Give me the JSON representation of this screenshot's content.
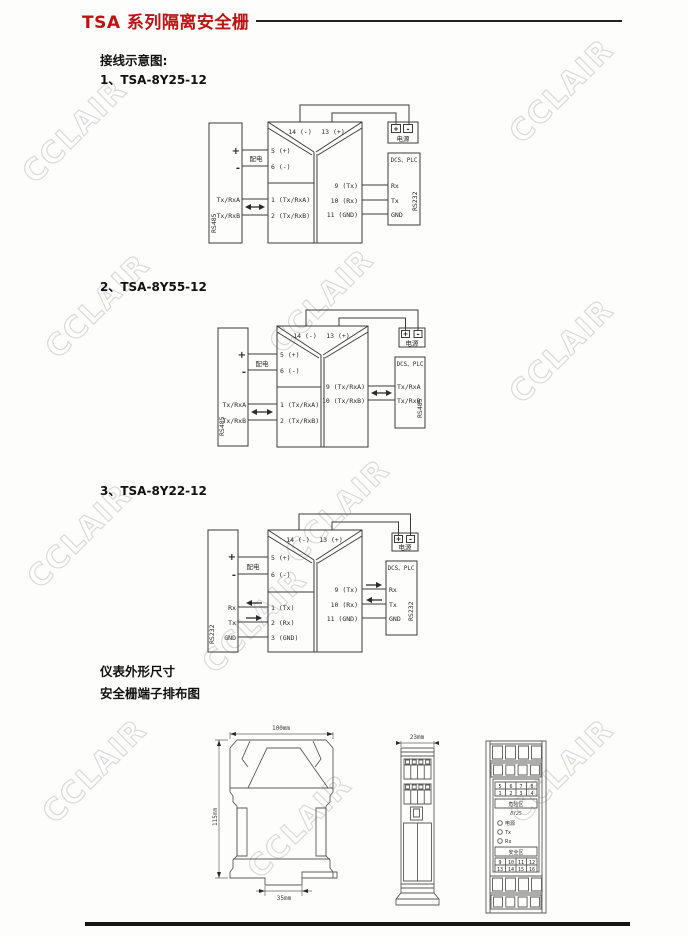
{
  "header": {
    "title": "TSA 系列隔离安全栅"
  },
  "headings": {
    "wiring": "接线示意图:",
    "item1": "1、TSA-8Y25-12",
    "item2": "2、TSA-8Y55-12",
    "item3": "3、TSA-8Y22-12",
    "dims": "仪表外形尺寸",
    "terminals": "安全栅端子排布图"
  },
  "watermark": {
    "text": "CCLAIR"
  },
  "colors": {
    "title_red": "#c01212",
    "line_black": "#1a1a1a",
    "stroke_gray": "#3c3c3c"
  },
  "diagram1": {
    "left_device": {
      "bus": "RS485",
      "plus": "+",
      "minus": "-",
      "power": "配电",
      "rows": [
        "Tx/RxA",
        "Tx/RxB"
      ]
    },
    "barrier": {
      "top": [
        "14 (-)",
        "13 (+)"
      ],
      "left_upper": [
        "5 (+)",
        "6 (-)"
      ],
      "left_lower": [
        "1 (Tx/RxA)",
        "2 (Tx/RxB)"
      ],
      "right": [
        "9 (Tx)",
        "10 (Rx)",
        "11 (GND)"
      ]
    },
    "power_box": {
      "plus": "+",
      "minus": "-",
      "label": "电源"
    },
    "right_device": {
      "title": "DCS、PLC",
      "rows": [
        "Rx",
        "Tx",
        "GND"
      ],
      "bus": "RS232"
    }
  },
  "diagram2": {
    "left_device": {
      "bus": "RS485",
      "plus": "+",
      "minus": "-",
      "power": "配电",
      "rows": [
        "Tx/RxA",
        "Tx/RxB"
      ]
    },
    "barrier": {
      "top": [
        "14 (-)",
        "13 (+)"
      ],
      "left_upper": [
        "5 (+)",
        "6 (-)"
      ],
      "left_lower": [
        "1 (Tx/RxA)",
        "2 (Tx/RxB)"
      ],
      "right": [
        "9 (Tx/RxA)",
        "10 (Tx/RxB)"
      ]
    },
    "power_box": {
      "plus": "+",
      "minus": "-",
      "label": "电源"
    },
    "right_device": {
      "title": "DCS、PLC",
      "rows": [
        "Tx/RxA",
        "Tx/RxB"
      ],
      "bus": "RS485"
    }
  },
  "diagram3": {
    "left_device": {
      "bus": "RS232",
      "plus": "+",
      "minus": "-",
      "power": "配电",
      "rows": [
        "Rx",
        "Tx",
        "GND"
      ]
    },
    "barrier": {
      "top": [
        "14 (-)",
        "13 (+)"
      ],
      "left_upper": [
        "5 (+)",
        "6 (-)"
      ],
      "left_lower": [
        "1 (Tx)",
        "2 (Rx)",
        "3 (GND)"
      ],
      "right": [
        "9 (Tx)",
        "10 (Rx)",
        "11 (GND)"
      ]
    },
    "power_box": {
      "plus": "+",
      "minus": "-",
      "label": "电源"
    },
    "right_device": {
      "title": "DCS、PLC",
      "rows": [
        "Rx",
        "Tx",
        "GND"
      ],
      "bus": "RS232"
    }
  },
  "outline_drawing": {
    "width": "100mm",
    "height": "115mm",
    "rail": "35mm"
  },
  "front_drawing": {
    "width": "23mm"
  },
  "terminal_card": {
    "top_row1": [
      "5",
      "6",
      "7",
      "8"
    ],
    "top_row2": [
      "1",
      "2",
      "3",
      "4"
    ],
    "hazard": "危险区",
    "model": "8Y25",
    "leds": [
      "电源",
      "Tx",
      "Rx"
    ],
    "safe": "安全区",
    "bottom_row1": [
      "9",
      "10",
      "11",
      "12"
    ],
    "bottom_row2": [
      "13",
      "14",
      "15",
      "16"
    ]
  }
}
